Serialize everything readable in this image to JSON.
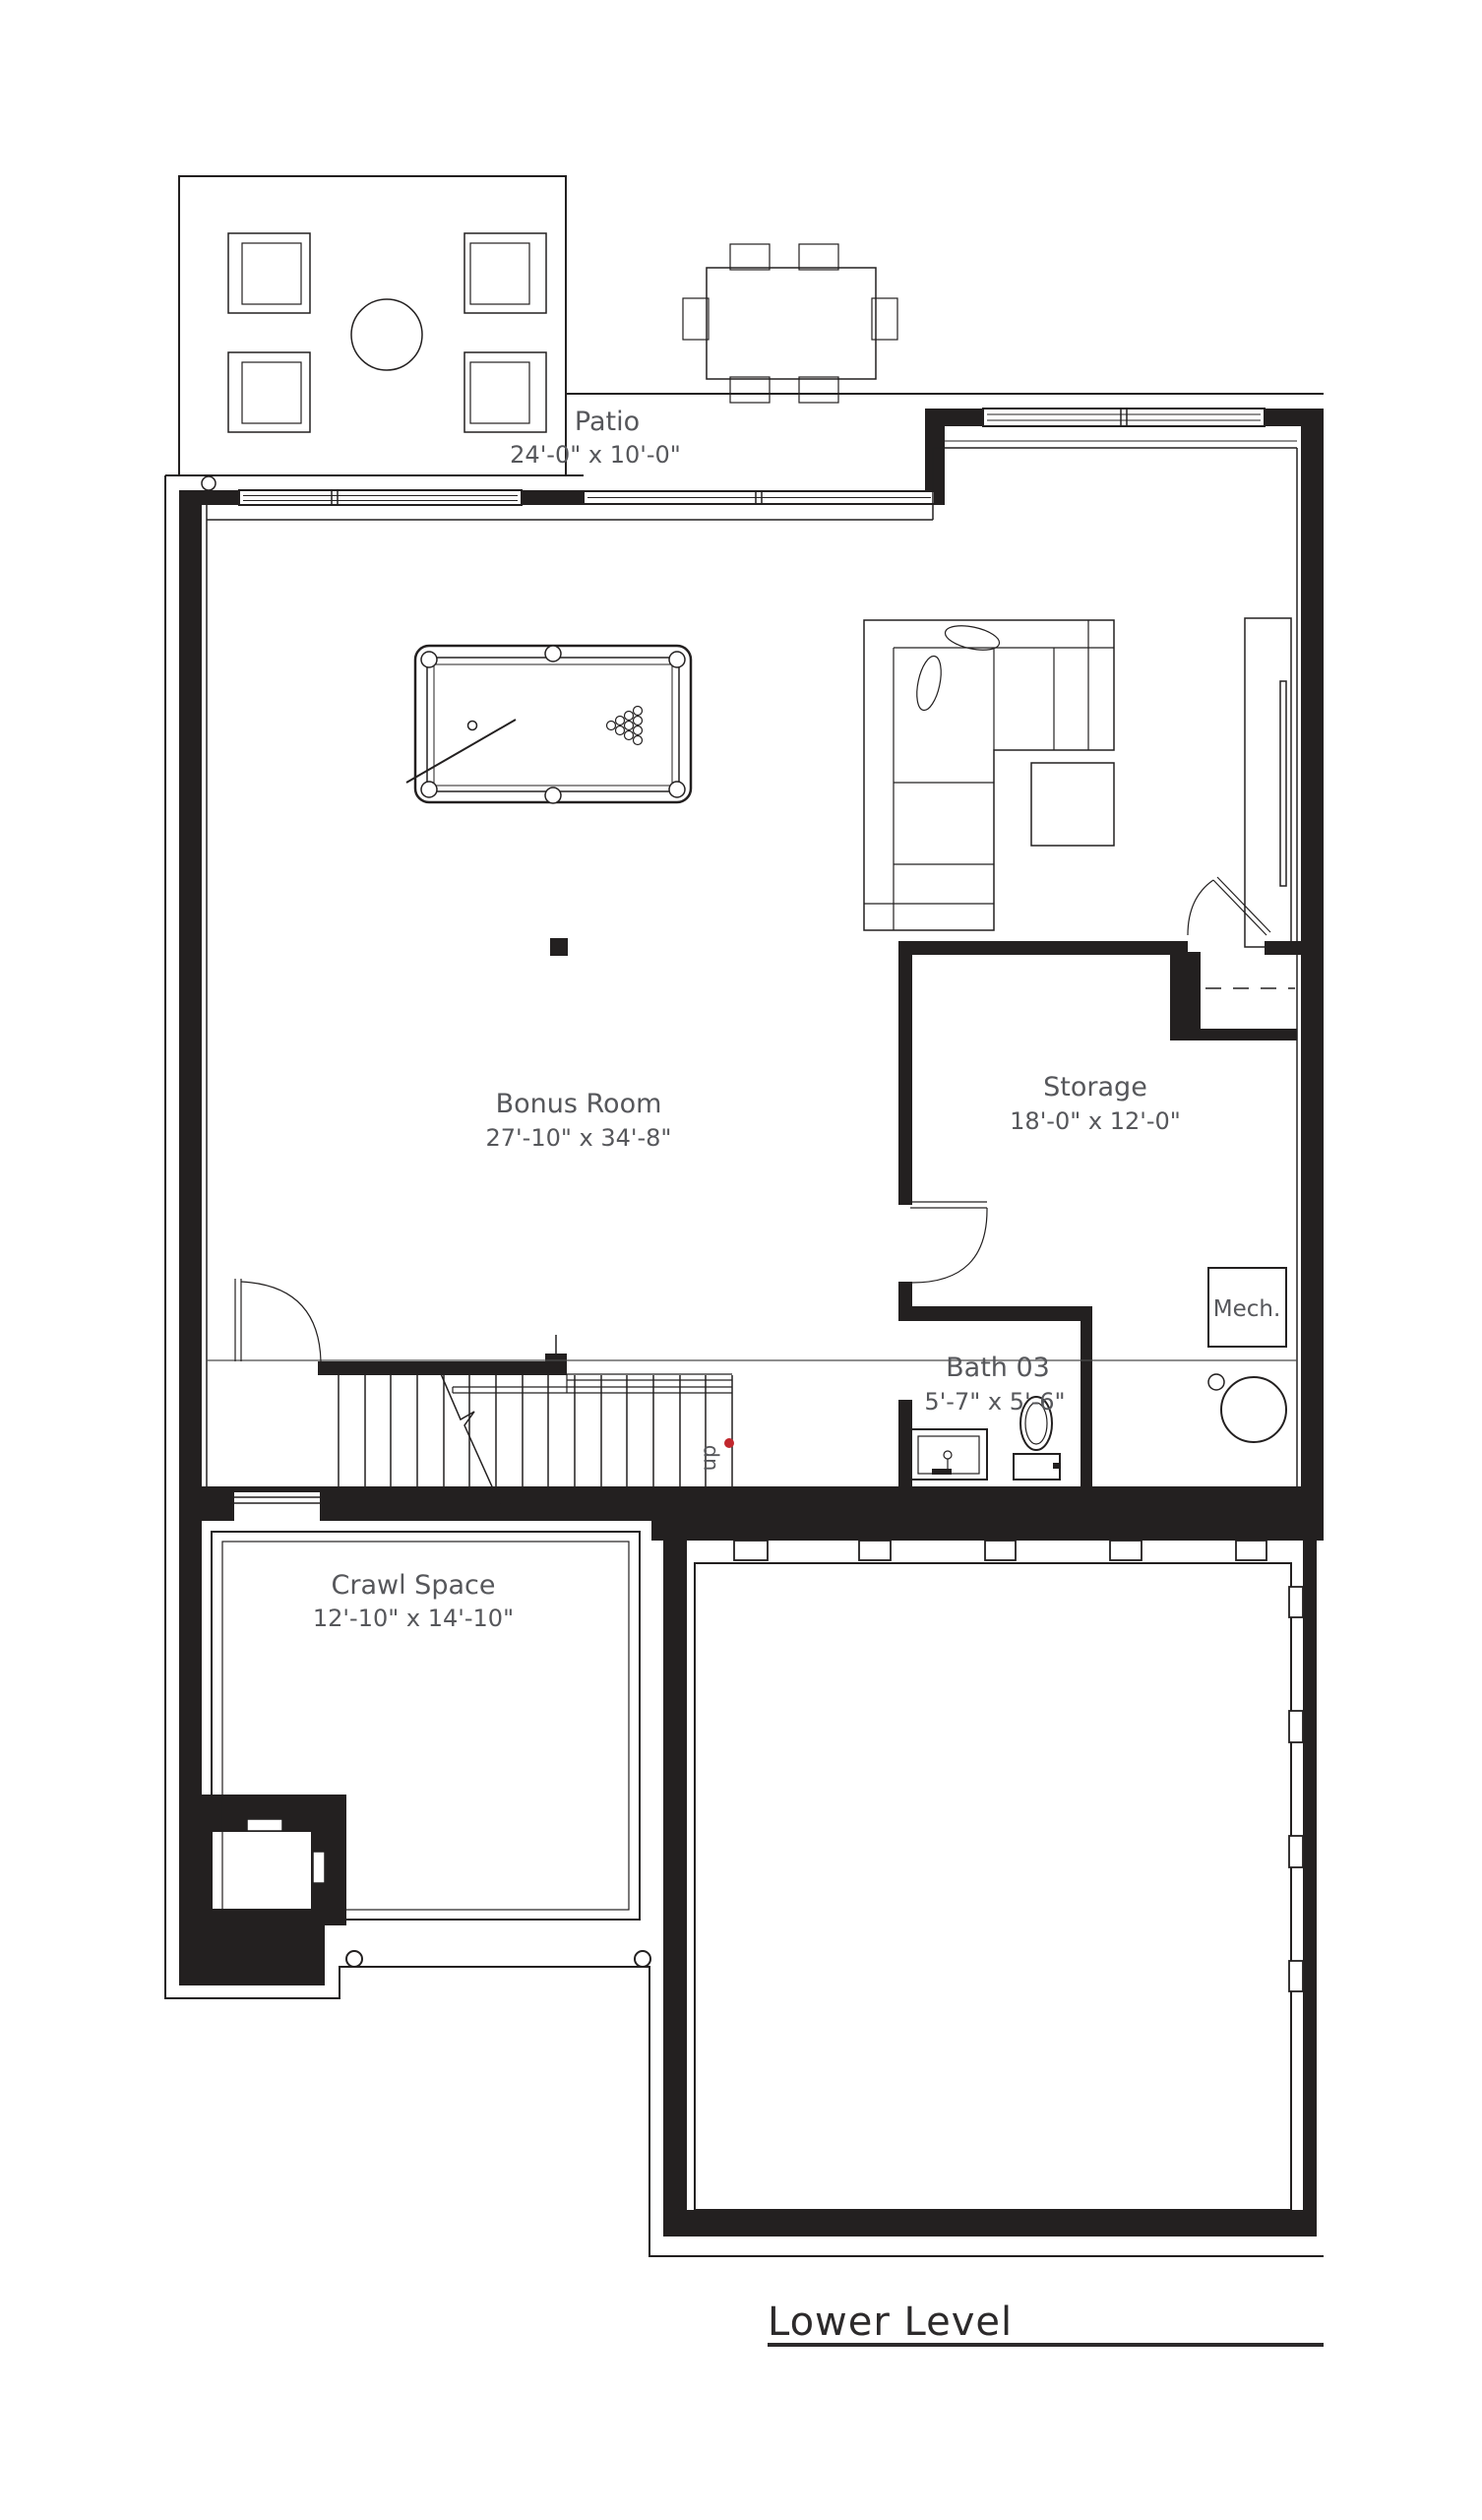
{
  "title": {
    "text": "Lower Level"
  },
  "colors": {
    "ink": "#232020",
    "label_gray": "#56575b",
    "stair_marker_red": "#c1272d",
    "background": "#ffffff"
  },
  "rooms": {
    "patio": {
      "name": "Patio",
      "dims": "24'-0\" x 10'-0\""
    },
    "bonus_room": {
      "name": "Bonus Room",
      "dims": "27'-10\" x 34'-8\""
    },
    "storage": {
      "name": "Storage",
      "dims": "18'-0\" x 12'-0\""
    },
    "bath_03": {
      "name": "Bath 03",
      "dims": "5'-7\" x 5'-6\""
    },
    "crawl_space": {
      "name": "Crawl Space",
      "dims": "12'-10\" x 14'-10\""
    },
    "mech": {
      "name": "Mech."
    }
  },
  "stairs": {
    "direction_label": "up"
  }
}
